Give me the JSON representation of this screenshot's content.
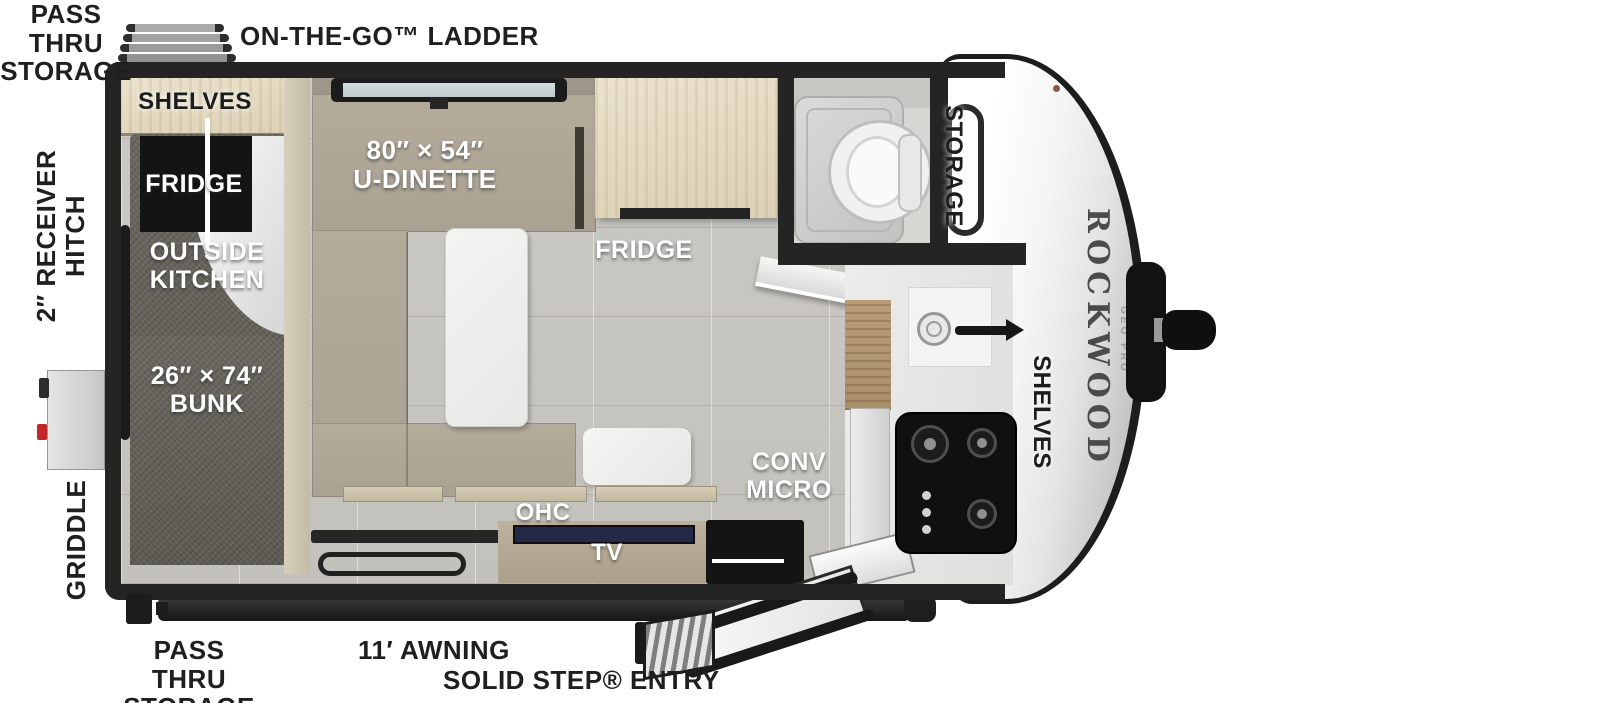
{
  "labels": {
    "pass_thru_top": "PASS THRU\nSTORAGE",
    "ladder": "ON-THE-GO™ LADDER",
    "hitch": "2″ RECEIVER\nHITCH",
    "griddle": "GRIDDLE",
    "pass_thru_bottom": "PASS THRU\nSTORAGE",
    "awning": "11′ AWNING",
    "entry": "SOLID STEP® ENTRY",
    "shelves_front": "SHELVES",
    "fridge_outside": "FRIDGE",
    "outside_kitchen": "OUTSIDE\nKITCHEN",
    "bunk": "26″ × 74″\nBUNK",
    "dinette": "80″ × 54″\nU-DINETTE",
    "fridge": "FRIDGE",
    "storage": "STORAGE",
    "conv_micro": "CONV\nMICRO",
    "ohc": "OHC",
    "tv": "TV",
    "shelves_kitchen": "SHELVES"
  },
  "branding": {
    "make": "ROCKWOOD",
    "model": "GEO PRO"
  },
  "colors": {
    "wall": "#242424",
    "floor_tile": "#c9c7c2",
    "bench_tan": "#b5ac9c",
    "cabinet_wood": "#e8dfc9",
    "kitchen_wood": "#b2976f",
    "bunk_carpet": "#635f58",
    "appliance_black": "#141414",
    "tv_screen": "#232946",
    "nose_white": "#f5f5f5",
    "label_black": "#1f1f1f",
    "griddle_red": "#c2272a"
  }
}
